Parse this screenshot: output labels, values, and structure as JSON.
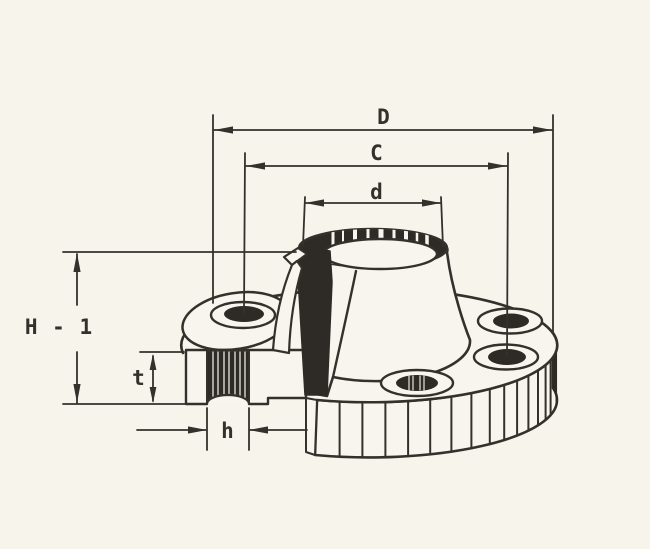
{
  "figure": {
    "kind": "technical-drawing",
    "subject": "weld-neck flange isometric cutaway section",
    "colors": {
      "background": "#f7f4ec",
      "ink": "#34312c",
      "section_fill": "#2e2b27",
      "face_fill": "#f8f5ee"
    }
  },
  "dimensions": {
    "outside_diameter": {
      "label": "D"
    },
    "bolt_circle_diameter": {
      "label": "C"
    },
    "hub_diameter": {
      "label": "d"
    },
    "overall_height": {
      "label": "H - 1"
    },
    "flange_thickness": {
      "label": "t"
    },
    "bolt_hole_diameter": {
      "label": "h"
    }
  }
}
